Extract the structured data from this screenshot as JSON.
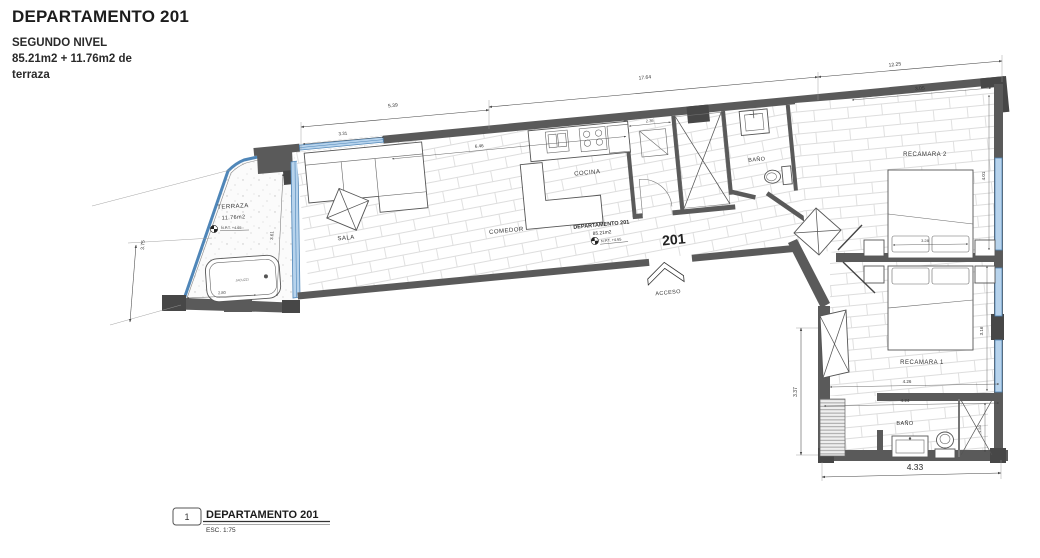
{
  "title_block": {
    "title": "DEPARTAMENTO 201",
    "subtitle": "SEGUNDO NIVEL",
    "area_line1": "85.21m2 + 11.76m2 de",
    "area_line2": "terraza"
  },
  "legend": {
    "index": "1",
    "title": "DEPARTAMENTO 201",
    "scale": "ESC. 1:75"
  },
  "unit": {
    "name": "DEPARTAMENTO 201",
    "area": "85.21m2",
    "npt": "N.P.T. +4.65",
    "number": "201"
  },
  "rooms": {
    "terraza": "TERRAZA",
    "terraza_area": "11.76m2",
    "terraza_npt": "N.P.T. +4.65",
    "sala": "SALA",
    "comedor": "COMEDOR",
    "cocina": "COCINA",
    "bano_1": "BAÑO",
    "bano_2": "BAÑO",
    "recamara_1": "RECAMARA 1",
    "recamara_2": "RECAMARA 2",
    "acceso": "ACCESO",
    "jacuzzi": "JACUZZI"
  },
  "dims": {
    "win_sala": "3.31",
    "sala_top": "5.39",
    "main_top": "17.64",
    "right_top": "12.25",
    "terraza_left": "3.75",
    "terraza_glass": "3.61",
    "terraza_bottom": "2.80",
    "interior_top": "6.46",
    "closet": "2.36",
    "rec2_top": "3.05",
    "rec2_bed": "3.28",
    "rec2_side": "4.01",
    "rec1_side": "3.16",
    "wing_left": "3.37",
    "rec1_width": "4.26",
    "bano2_width": "4.24",
    "wing_bottom": "4.33",
    "shower": "1.50"
  },
  "colors": {
    "wall": "#5a5a5a",
    "glass_fill": "#b7d3ec",
    "glass_stroke": "#4f86b8",
    "ink": "#2b2b2b"
  }
}
